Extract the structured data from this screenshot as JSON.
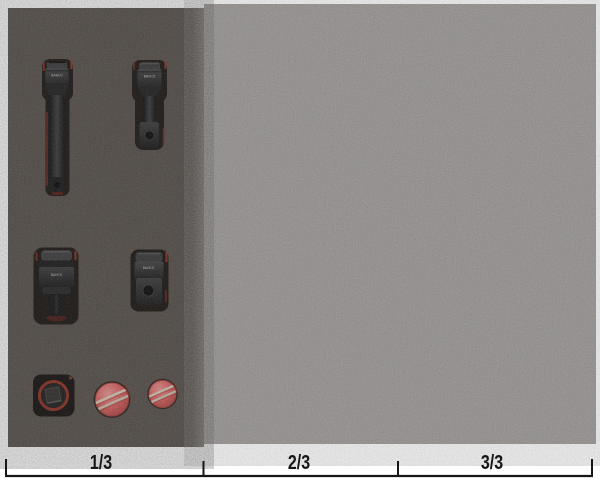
{
  "ruler": {
    "labels": [
      "1/3",
      "2/3",
      "3/3"
    ]
  },
  "etch": {
    "brand": "BAHCO"
  },
  "colors": {
    "background": "#ffffff",
    "foam_dark": "#57504a",
    "foam_dark_bevel": "#78716a",
    "foam_light": "#9a9694",
    "cutout_shadow": "#16110d",
    "accent_red": "#a23322",
    "accent_red_dark": "#7d241a",
    "knob_red": "#e4615f",
    "knob_slot": "#e0d5c2",
    "tool_black": "#1a1a1c",
    "ruler_ink": "#161616"
  }
}
